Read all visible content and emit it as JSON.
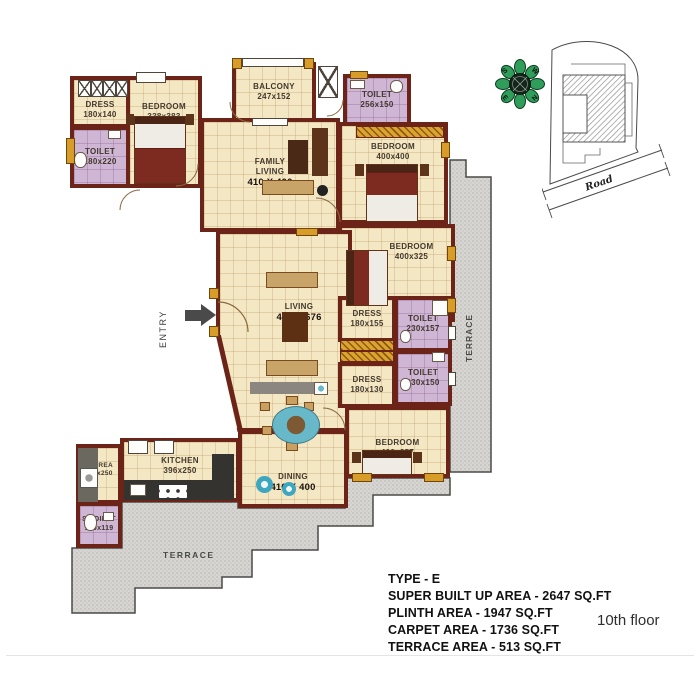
{
  "plan": {
    "rooms": {
      "dress_a": {
        "name": "DRESS",
        "dims": "180x140"
      },
      "bedroom_a": {
        "name": "BEDROOM",
        "dims": "338x383"
      },
      "toilet_a": {
        "name": "TOILET",
        "dims": "180x220"
      },
      "balcony": {
        "name": "BALCONY",
        "dims": "247x152"
      },
      "toilet_top": {
        "name": "TOILET",
        "dims": "256x150"
      },
      "family_living": {
        "name": "FAMILY LIVING",
        "dims": "410 X 400"
      },
      "bedroom_b": {
        "name": "BEDROOM",
        "dims": "400x400"
      },
      "bedroom_c": {
        "name": "BEDROOM",
        "dims": "400x325"
      },
      "living": {
        "name": "LIVING",
        "dims": "410 X 676"
      },
      "dress_b": {
        "name": "DRESS",
        "dims": "180x155"
      },
      "toilet_b": {
        "name": "TOILET",
        "dims": "230x157"
      },
      "toilet_c": {
        "name": "TOILET",
        "dims": "230x150"
      },
      "dress_c": {
        "name": "DRESS",
        "dims": "180x130"
      },
      "bedroom_d": {
        "name": "BEDROOM",
        "dims": "400x257"
      },
      "dining": {
        "name": "DINING",
        "dims": "410 X 400"
      },
      "kitchen": {
        "name": "KITCHEN",
        "dims": "396x250"
      },
      "w_area": {
        "name": "W AREA",
        "dims": "155x250"
      },
      "s_toilet": {
        "name": "S.TOILET",
        "dims": "150x119"
      }
    },
    "entry_label": "ENTRY",
    "terrace_bottom_label": "TERRACE",
    "terrace_right_label": "TERRACE"
  },
  "compass": {
    "n": "N",
    "e": "E",
    "s": "S",
    "w": "W"
  },
  "site_map": {
    "road_label": "Road"
  },
  "info": {
    "type": "TYPE - E",
    "lines": [
      "SUPER BUILT UP AREA - 2647 SQ.FT",
      "PLINTH AREA - 1947 SQ.FT",
      "CARPET AREA - 1736 SQ.FT",
      "TERRACE AREA - 513 SQ.FT"
    ],
    "floor": "10th floor"
  },
  "colors": {
    "wall": "#6d2418",
    "floor": "#f4e7c4",
    "toilet": "#cfb6d4",
    "terrace": "#d7d6d3",
    "accent_gold": "#d89c28",
    "compass_green": "#2f9e5b",
    "teal": "#3fa6c0"
  }
}
